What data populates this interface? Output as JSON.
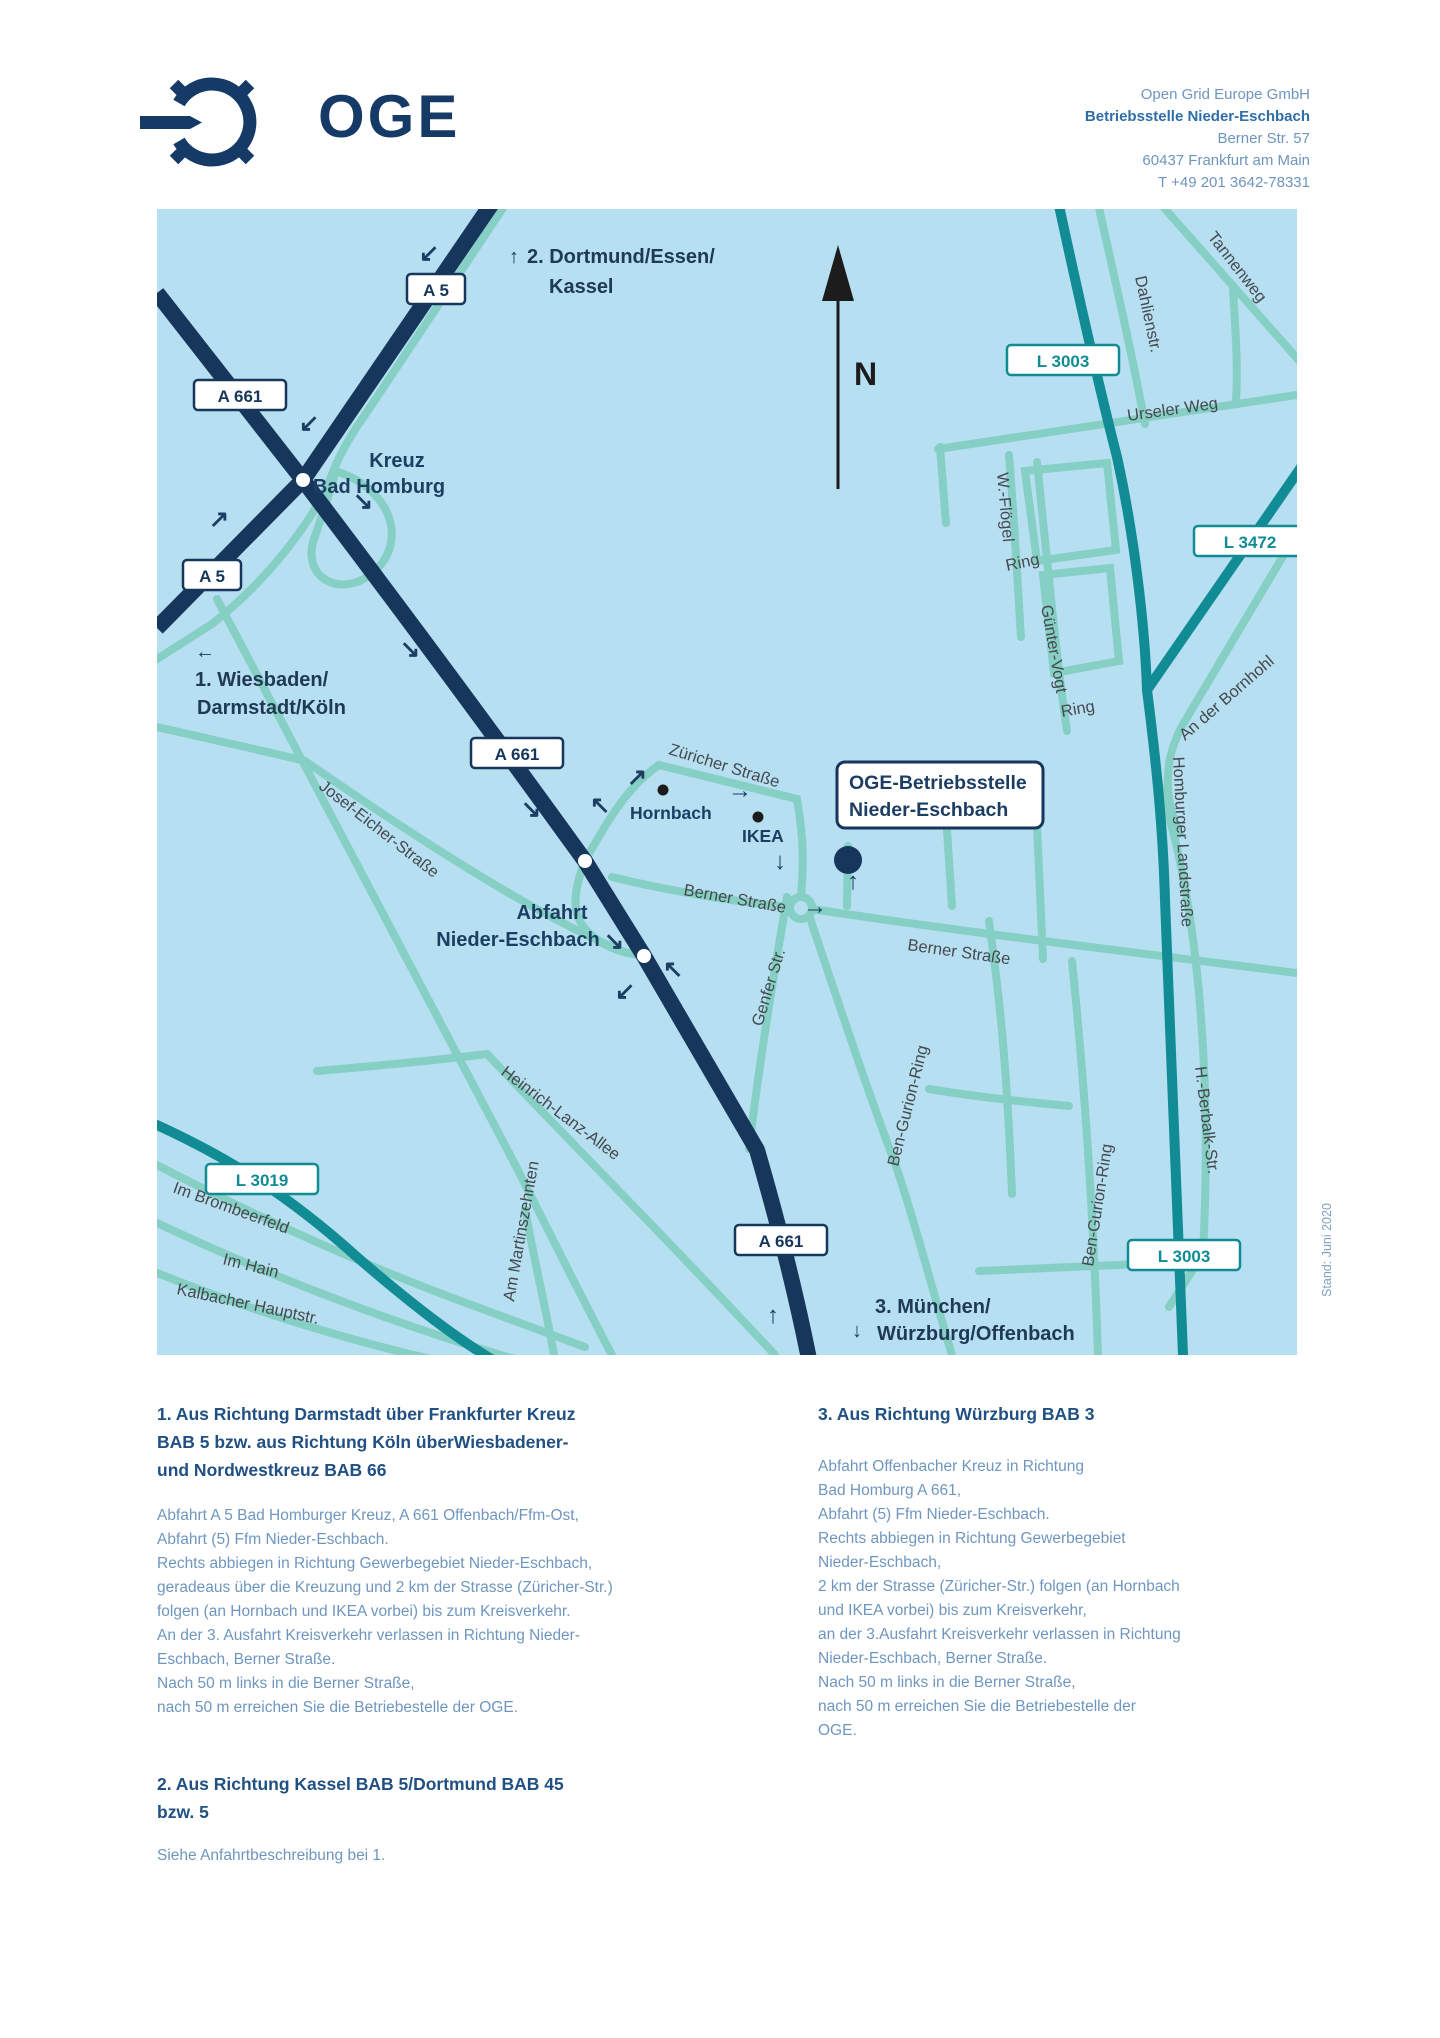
{
  "logo": {
    "text": "OGE"
  },
  "address": {
    "l1": "Open Grid Europe GmbH",
    "l2": "Betriebsstelle Nieder-Eschbach",
    "l3": "Berner Str. 57",
    "l4": "60437 Frankfurt am Main",
    "l5": "T +49 201 3642-78331"
  },
  "map": {
    "compass": "N",
    "stand_note": "Stand: Juni 2020",
    "badges": {
      "a5_top": "A 5",
      "a661_left": "A 661",
      "a5_left": "A 5",
      "a661_mid": "A 661",
      "a661_bottom": "A 661",
      "l3003_top": "L 3003",
      "l3472": "L 3472",
      "l3019": "L 3019",
      "l3003_bottom": "L 3003"
    },
    "places": {
      "kreuz_line1": "Kreuz",
      "kreuz_line2": "Bad Homburg",
      "abfahrt_line1": "Abfahrt",
      "abfahrt_line2": "Nieder-Eschbach",
      "hornbach": "Hornbach",
      "ikea": "IKEA"
    },
    "callout": {
      "line1": "OGE-Betriebsstelle",
      "line2": "Nieder-Eschbach"
    },
    "directions": {
      "d1_arrow": "←",
      "d1_line1": "1. Wiesbaden/",
      "d1_line2": "Darmstadt/Köln",
      "d2_arrow": "↑",
      "d2_line1": "2. Dortmund/Essen/",
      "d2_line2": "Kassel",
      "d3_arrow": "↓",
      "d3_line1": "3. München/",
      "d3_line2": "Würzburg/Offenbach"
    },
    "streets": {
      "zuericher": "Züricher Straße",
      "berner1": "Berner Straße",
      "berner2": "Berner Straße",
      "genfer": "Genfer Str.",
      "ben_gurion_w": "Ben-Gurion-Ring",
      "ben_gurion_e": "Ben-Gurion-Ring",
      "berbalk": "H.-Berbalk-Str.",
      "homburger": "Homburger Landstraße",
      "bornhohl": "An der Bornhohl",
      "urseler": "Urseler Weg",
      "tannenweg": "Tannenweg",
      "dahlien": "Dahlienstr.",
      "wfloegel": "W.-Flögel",
      "ring_w": "Ring",
      "guenter": "Günter-Vogt",
      "ring_g": "Ring",
      "josef": "Josef-Eicher-Straße",
      "heinrich": "Heinrich-Lanz-Allee",
      "martins": "Am Martinszehnten",
      "brombeer": "Im Brombeerfeld",
      "imhain": "Im Hain",
      "kalbacher": "Kalbacher Hauptstr."
    },
    "road_arrows": {
      "ra1": "↙",
      "ra2": "↙",
      "ra3": "↘",
      "ra4": "↗",
      "ra5": "↘",
      "ra6": "↘",
      "ra7": "↖",
      "ra8": "↗",
      "ra9": "→",
      "ra10": "↓",
      "ra11": "↑",
      "ra12": "→",
      "ra13": "↘",
      "ra14": "↖",
      "ra15": "↙",
      "ra16": "↑"
    }
  },
  "sections": {
    "s1": {
      "heading": "1. Aus Richtung Darmstadt über Frankfurter Kreuz\nBAB 5 bzw. aus Richtung Köln überWiesbadener-\nund Nordwestkreuz BAB 66",
      "body": "Abfahrt A 5 Bad Homburger Kreuz, A 661 Offenbach/Ffm-Ost,\nAbfahrt (5) Ffm Nieder-Eschbach.\nRechts abbiegen in Richtung Gewerbegebiet Nieder-Eschbach,\ngeradeaus über die Kreuzung und 2 km der Strasse (Züricher-Str.)\nfolgen (an Hornbach und IKEA vorbei) bis zum Kreisverkehr.\nAn der 3. Ausfahrt Kreisverkehr verlassen in Richtung Nieder-\nEschbach, Berner Straße.\nNach 50 m links in die Berner Straße,\nnach 50 m erreichen Sie die Betriebestelle der OGE."
    },
    "s2": {
      "heading": "2. Aus Richtung Kassel BAB 5/Dortmund BAB 45\nbzw. 5",
      "body": "Siehe Anfahrtbeschreibung bei 1."
    },
    "s3": {
      "heading": "3. Aus Richtung Würzburg BAB 3",
      "body": "Abfahrt Offenbacher Kreuz in Richtung\nBad Homburg A 661,\nAbfahrt (5) Ffm Nieder-Eschbach.\nRechts abbiegen in Richtung Gewerbegebiet\nNieder-Eschbach,\n2 km der Strasse (Züricher-Str.) folgen (an Hornbach\nund IKEA vorbei) bis zum Kreisverkehr,\nan der 3.Ausfahrt Kreisverkehr verlassen in Richtung\nNieder-Eschbach, Berner Straße.\nNach 50 m links in die Berner Straße,\nnach 50 m erreichen Sie die Betriebestelle der\nOGE."
    }
  },
  "colors": {
    "navy": "#16365c",
    "teal": "#118c94",
    "light_teal": "#85cfc4",
    "map_bg": "#b6dff1",
    "heading": "#215083",
    "body": "#6e96be"
  }
}
